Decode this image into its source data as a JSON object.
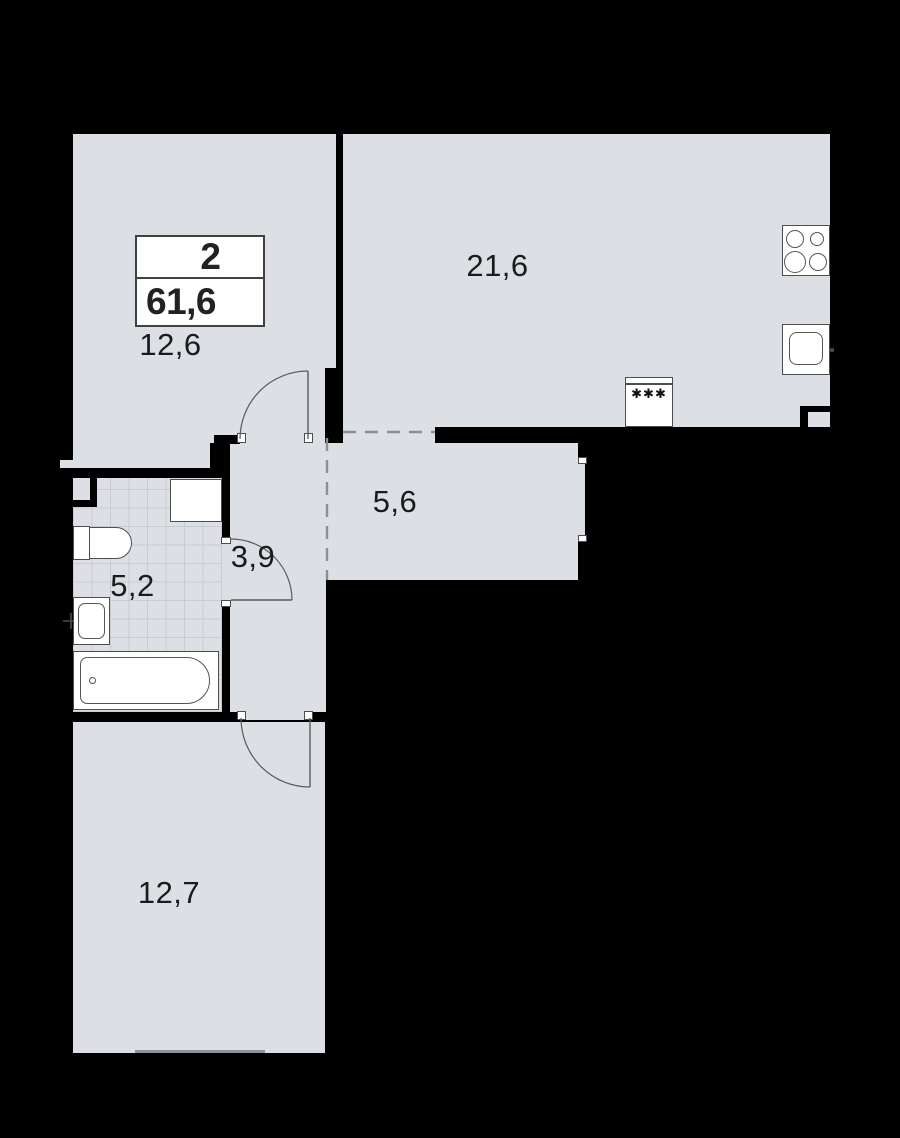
{
  "unit_card": {
    "room_count": "2",
    "total_area": "61,6"
  },
  "areas": {
    "living_kitchen": "21,6",
    "bedroom_top": "12,6",
    "corridor": "5,6",
    "hall": "3,9",
    "bathroom": "5,2",
    "bedroom_bottom": "12,7"
  },
  "icons": {
    "fridge_symbol": "✱✱✱"
  },
  "colors": {
    "background": "#000000",
    "floor": "#dce0e5",
    "tile_line": "#c7ccd3",
    "wall": "#000000",
    "fixture_stroke": "#4d4d4d",
    "dashed_zone_line": "#8a8f96"
  }
}
